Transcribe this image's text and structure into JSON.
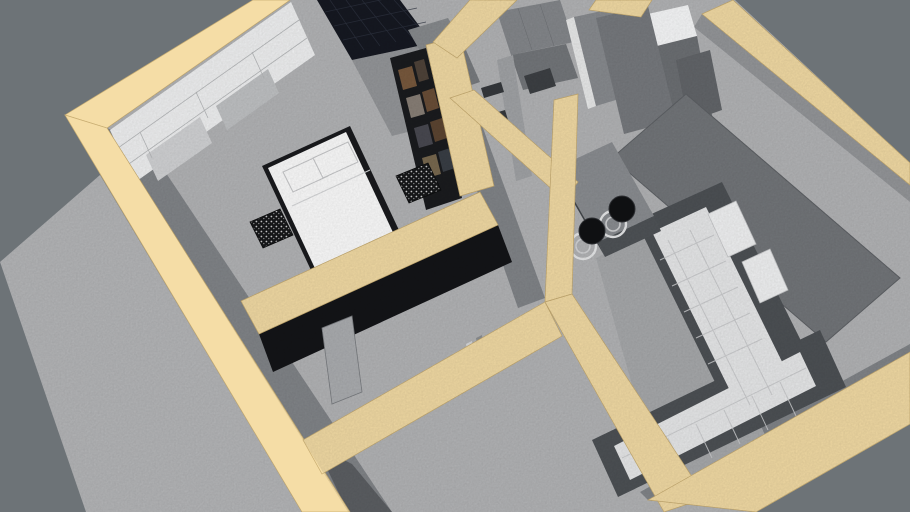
{
  "app": {
    "type": "3d-floorplan-render",
    "description": "Overhead perspective 3D render of a small apartment model with cream wall tops, gray floors, dark bedroom walls and a gray-blue backdrop",
    "view": "orbit-perspective from above"
  },
  "palette": {
    "background": "#6d7377",
    "wall_top": "#f5dda6",
    "wall_top_edge": "#c8ad72",
    "floor": "#b5b6b8",
    "balcony_floor": "#b7b8ba",
    "wall_face": "#83868a",
    "wall_face_light": "#96989b",
    "wall_face_dark": "#5d6064",
    "dark_wall": "#141518",
    "tile_wall": "#161922",
    "wardrobe_white": "#f3f4f5",
    "bookshelf_dark": "#1b1c1f",
    "bed_linen": "#ffffff",
    "bed_frame": "#1a1b1e",
    "sofa_frame": "#4e5256",
    "sofa_cushion": "#eaebec",
    "sofa_back_cushion": "#f4f5f6",
    "rug": "#74777b",
    "carpet": "#a9abad",
    "counter_top": "#8c8f93",
    "counter_front": "#505458",
    "stool_seat": "#111214",
    "stool_ring": "#e9eaeb",
    "door": "#8a8d91",
    "door_edge": "#eceded",
    "cabinet": "#86898d",
    "cabinet_dark": "#75787c",
    "white_cabinet": "#fafbfc",
    "fixture": "#898c8f",
    "hall_door": "#adafb2"
  },
  "rooms": [
    {
      "name": "bedroom",
      "position": "top-left",
      "furniture": [
        "double bed with white duvet",
        "2 white pillows",
        "white wardrobe shelving unit",
        "dark bookshelf wall",
        "2 speckled nightstands"
      ],
      "wall_style": "black accent walls"
    },
    {
      "name": "bathroom",
      "position": "top-center",
      "features": [
        "dark navy mosaic tile wall",
        "gray fixtures"
      ]
    },
    {
      "name": "entry-hall",
      "position": "top-center-right",
      "furniture": [
        "front door with hinges",
        "built-in cabinets",
        "white cabinet",
        "tall gray wardrobe"
      ]
    },
    {
      "name": "corridor",
      "position": "center",
      "furniture": [
        "floating wall shelves",
        "doorway to bedroom"
      ]
    },
    {
      "name": "living-room",
      "position": "right",
      "furniture": [
        "L-shaped tufted sectional sofa",
        "dark gray rug",
        "light carpet",
        "wall bar counter",
        "2 black bar stools",
        "kitchen cabinet block"
      ]
    },
    {
      "name": "hallway",
      "position": "bottom-center",
      "furniture": [
        "leaning door panel",
        "door frame"
      ]
    },
    {
      "name": "balcony",
      "position": "left",
      "furniture": []
    }
  ],
  "objects": {
    "bar_stool_count": 2,
    "pillow_count": 2,
    "sofa_type": "L-shaped sectional with tufted cushions",
    "wall_top_finish": "cream / beige plan-cut outline",
    "floor_finish": "gray concrete-like texture"
  }
}
